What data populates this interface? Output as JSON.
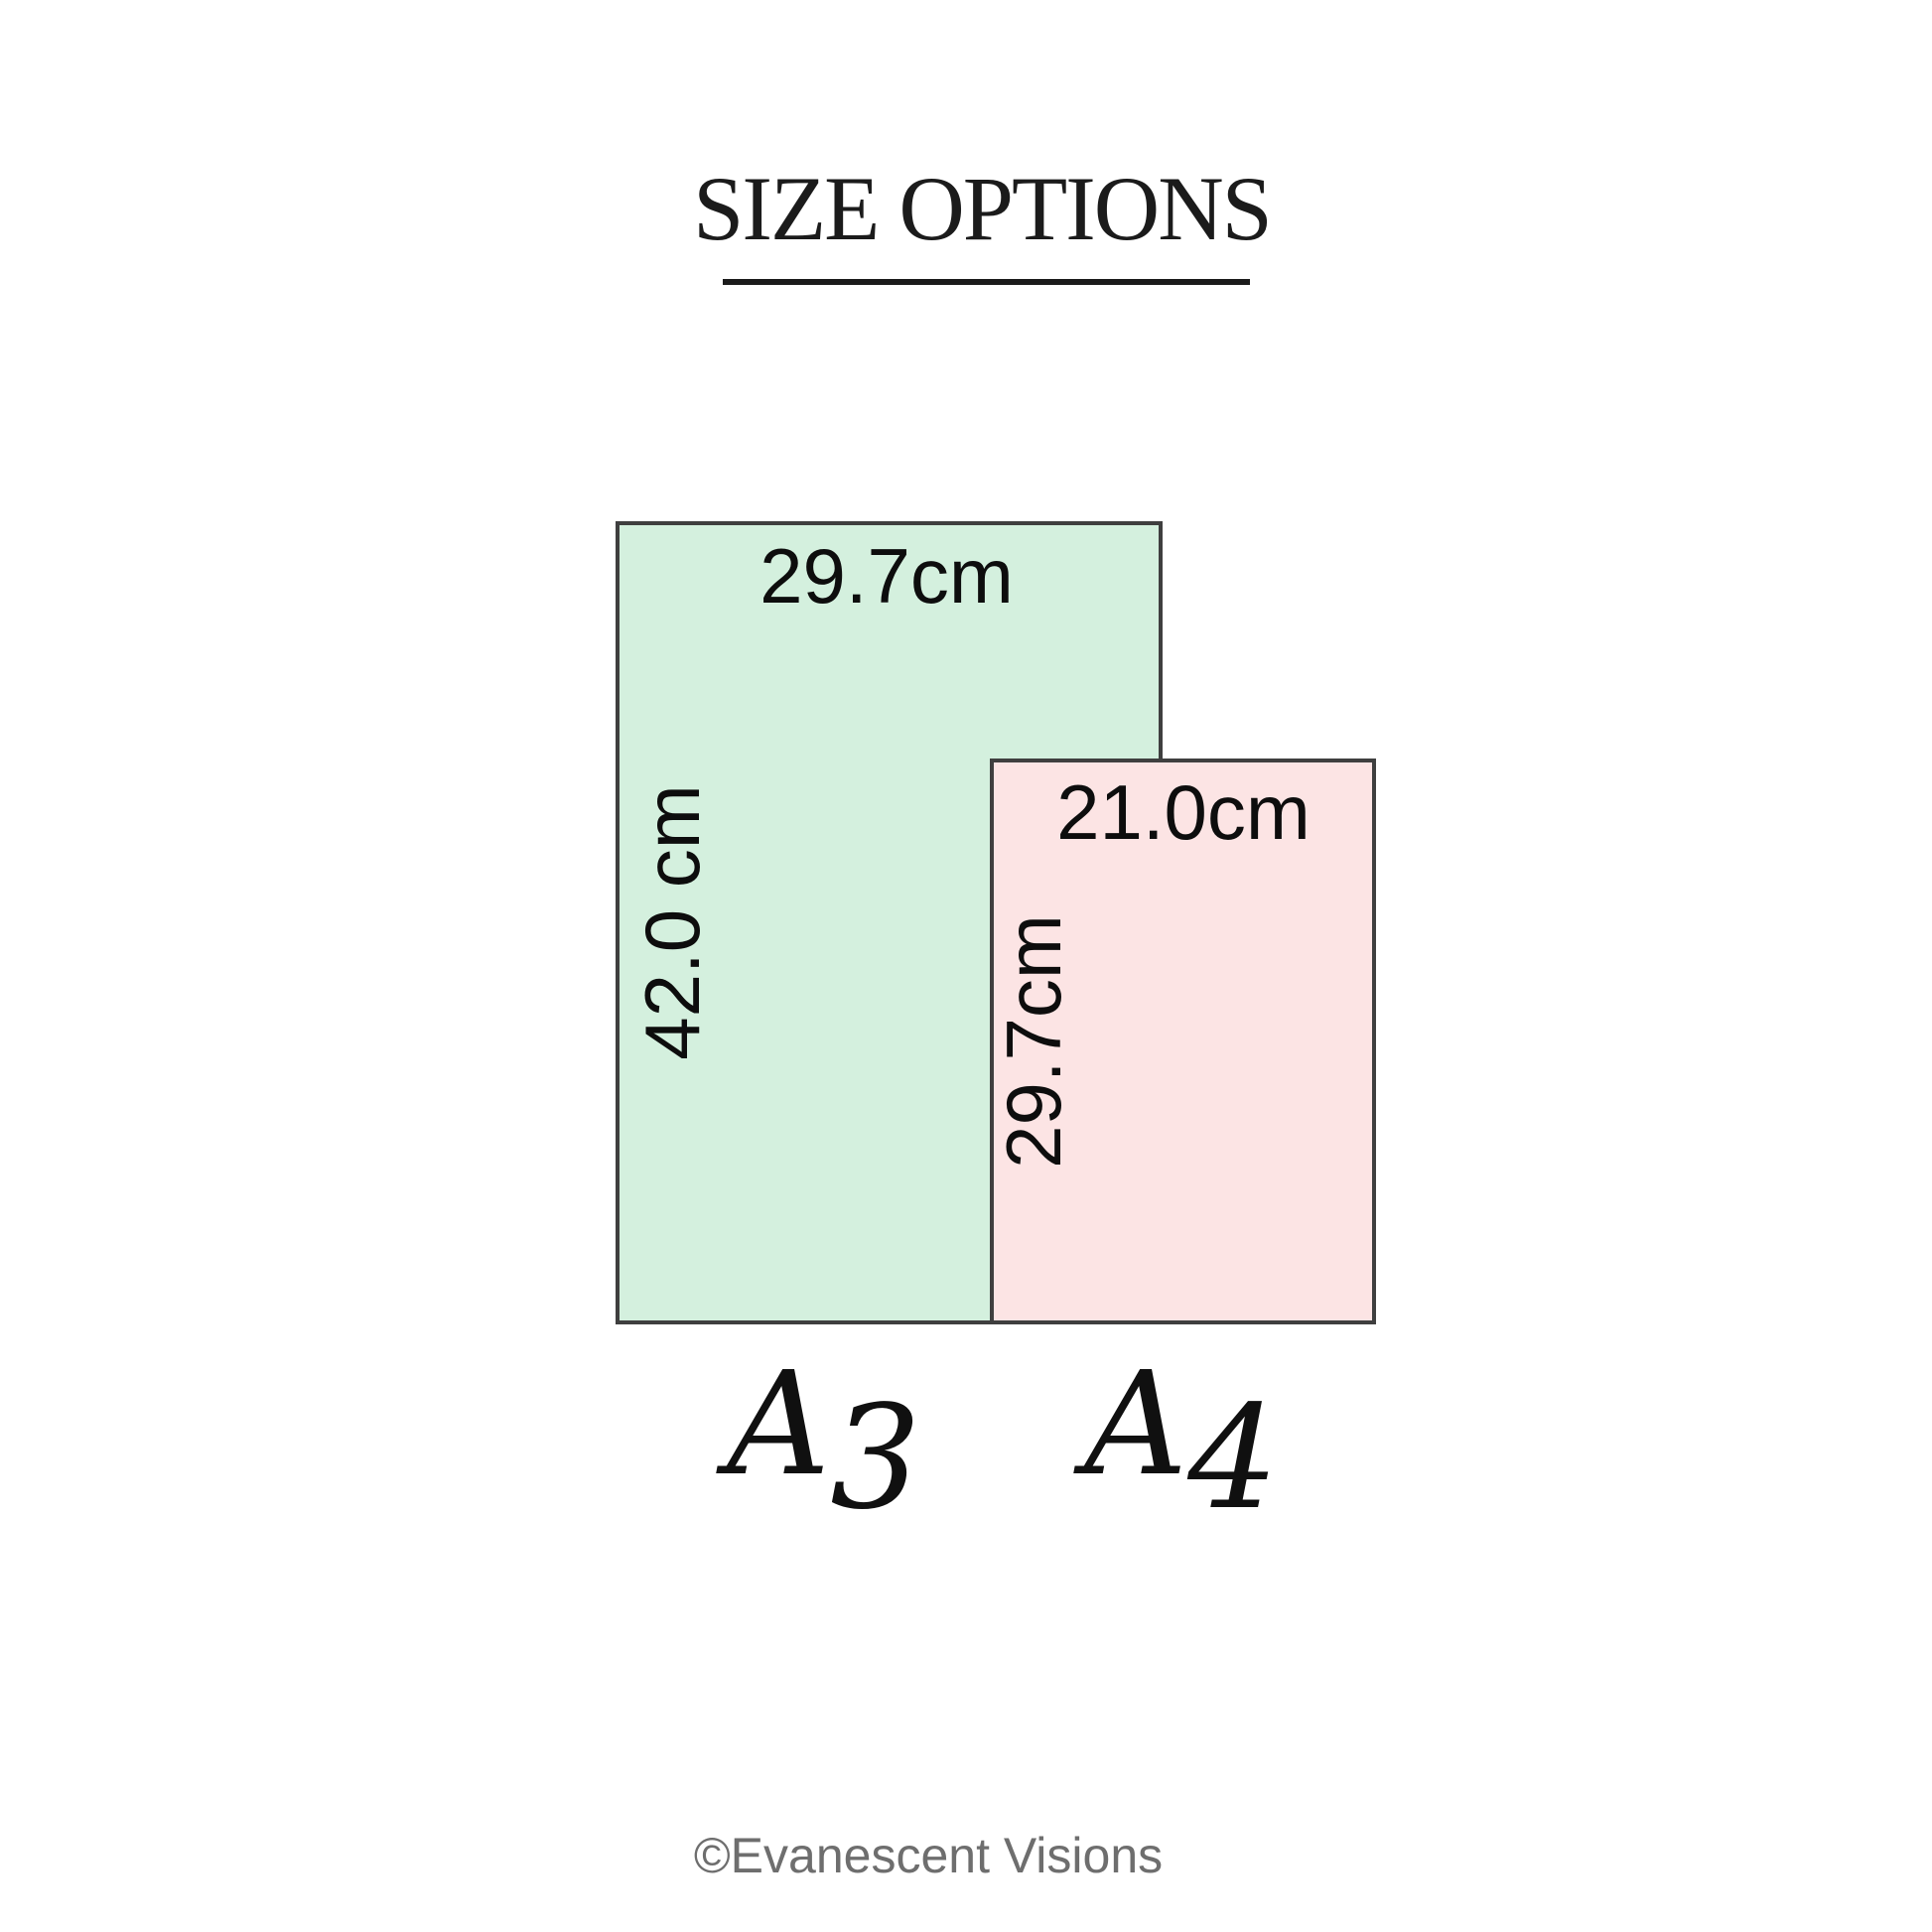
{
  "title": "SIZE OPTIONS",
  "sizes": [
    {
      "name": "A3",
      "name_letter": "A",
      "name_digit": "3",
      "width_label": "29.7cm",
      "height_label": "42.0 cm",
      "fill_color": "#d4f0de"
    },
    {
      "name": "A4",
      "name_letter": "A",
      "name_digit": "4",
      "width_label": "21.0cm",
      "height_label": "29.7cm",
      "fill_color": "#fce4e4"
    }
  ],
  "copyright": "©Evanescent Visions",
  "colors": {
    "background": "#ffffff",
    "a3_fill": "#d4f0de",
    "a4_fill": "#fce4e4",
    "rect_border": "#3f3f3f",
    "dimension_text": "#0d0d0d",
    "title_text": "#1b1b1b",
    "copyright_text": "#6e6e6e"
  }
}
